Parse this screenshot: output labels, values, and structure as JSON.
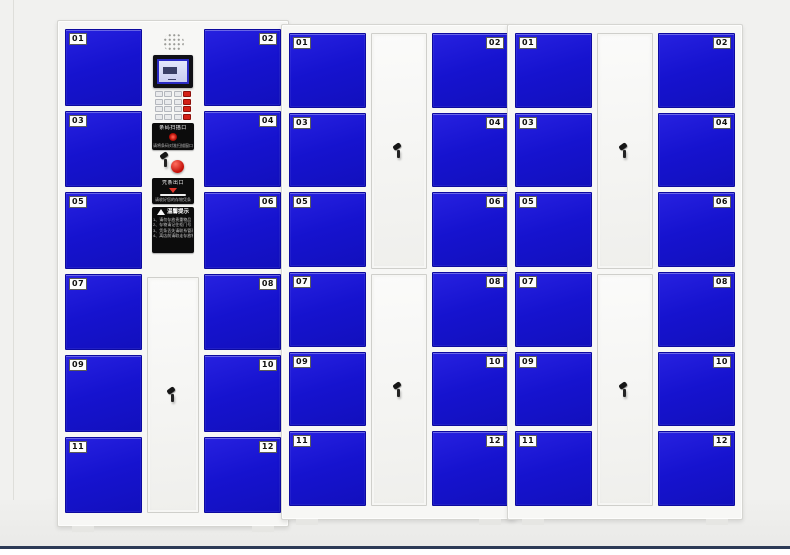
{
  "scene": {
    "background_color": "#f1f1ef",
    "baseline_color": "#2c3a56",
    "door_color": "#1613cf"
  },
  "cabinets": [
    {
      "name": "cabinet-1",
      "left_doors": [
        "01",
        "03",
        "05",
        "07",
        "09",
        "11"
      ],
      "right_doors": [
        "02",
        "04",
        "06",
        "08",
        "10",
        "12"
      ]
    },
    {
      "name": "cabinet-2",
      "left_doors": [
        "01",
        "03",
        "05",
        "07",
        "09",
        "11"
      ],
      "right_doors": [
        "02",
        "04",
        "06",
        "08",
        "10",
        "12"
      ]
    },
    {
      "name": "cabinet-3",
      "left_doors": [
        "01",
        "03",
        "05",
        "07",
        "09",
        "11"
      ],
      "right_doors": [
        "02",
        "04",
        "06",
        "08",
        "10",
        "12"
      ]
    }
  ],
  "panel": {
    "scanner_label": "条码扫描口",
    "scanner_sub": "请将条码对准扫描窗口",
    "receipt_label": "凭条出口",
    "receipt_sub": "请收好您的存物凭条",
    "tips_title": "温馨提示",
    "tips_lines": [
      "1、请勿存放贵重物品",
      "2、存物请记住柜门号",
      "3、凭条丢失请联系管理员",
      "4、离店前请取走存放物品"
    ]
  }
}
